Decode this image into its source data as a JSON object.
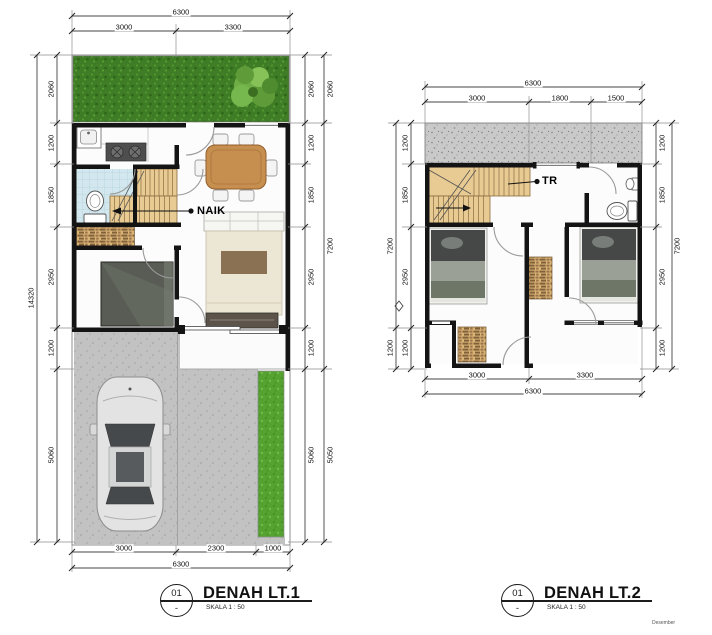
{
  "footer_note": "Desember",
  "plan1": {
    "ref_number": "01",
    "ref_dash": "-",
    "title": "DENAH LT.1",
    "scale_label": "SKALA 1 : 50",
    "stairs_label": "NAIK",
    "dims": {
      "top_total": "6300",
      "top_seg1": "3000",
      "top_seg2": "3300",
      "side_total": "14320",
      "s1": "2060",
      "s2": "1200",
      "s3": "1850",
      "s4": "2950",
      "s5": "1200",
      "s6": "5060",
      "outer1": "2060",
      "outer2": "7200",
      "outer3": "5050",
      "bottom_seg1": "3000",
      "bottom_seg2": "2300",
      "bottom_seg3": "1000",
      "bottom_total": "6300"
    }
  },
  "plan2": {
    "ref_number": "01",
    "ref_dash": "-",
    "title": "DENAH LT.2",
    "scale_label": "SKALA 1 : 50",
    "stairs_label": "TR",
    "dims": {
      "top_total": "6300",
      "top_seg1": "3000",
      "top_seg2": "1800",
      "top_seg3": "1500",
      "s1": "1200",
      "s2": "1850",
      "s3": "2950",
      "s4": "1200",
      "outer_side": "7200",
      "outer_extra": "1200",
      "bottom_seg1": "3000",
      "bottom_seg2": "3300",
      "bottom_total": "6300"
    }
  }
}
